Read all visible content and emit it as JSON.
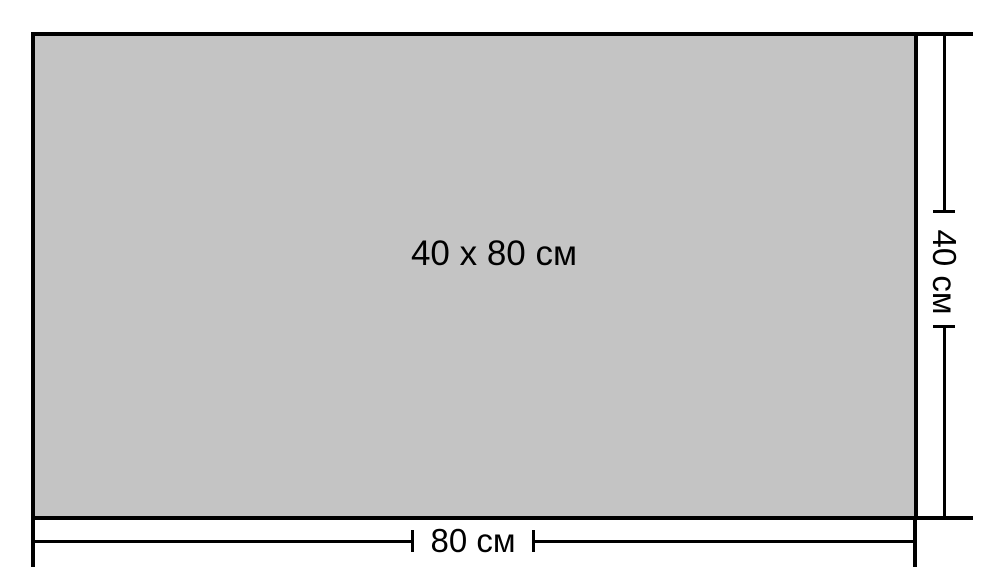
{
  "diagram": {
    "type": "dimension-drawing",
    "background": "#ffffff",
    "rectangle": {
      "fill": "#c4c4c4",
      "border_color": "#000000",
      "label": "40 x 80 см"
    },
    "dimensions": {
      "height": {
        "label": "40 см"
      },
      "width": {
        "label": "80 см"
      }
    }
  }
}
